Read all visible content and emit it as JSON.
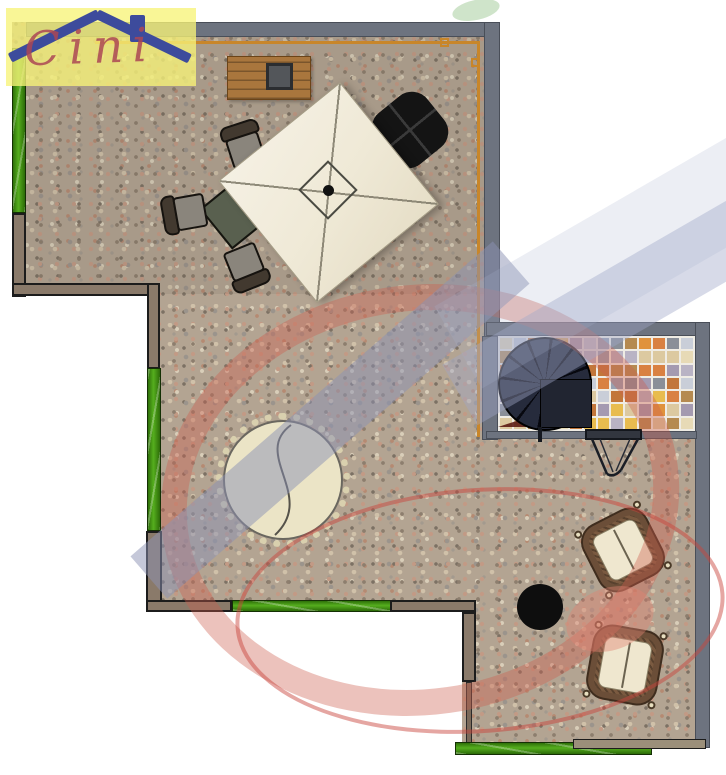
{
  "logo": {
    "text": "Cini"
  },
  "plan": {
    "kind": "terrace floor plan (top view)",
    "areas": [
      {
        "id": "upper-terrace",
        "floor": "pebble-stone"
      },
      {
        "id": "middle-terrace",
        "floor": "pebble-stone"
      },
      {
        "id": "stair-room",
        "floor": "mosaic-tiles"
      },
      {
        "id": "lower-terrace",
        "floor": "pebble-stone"
      }
    ],
    "furniture": [
      "wooden-bench",
      "serving-tray",
      "square-parasol",
      "cantilever-parasol-base",
      "dining-table",
      "dining-chair",
      "dining-chair",
      "dining-chair",
      "round-daybed",
      "spiral-staircase",
      "stair-landing",
      "folding-chair",
      "wicker-armchair",
      "wicker-armchair",
      "round-side-table"
    ]
  },
  "colors": {
    "wall_gray": "#6d737f",
    "wall_green": "#3a8a10",
    "wall_brown": "#8a7a6a",
    "wall_tan": "#9b8f7a",
    "railing_orange": "#c8862a",
    "parasol_cream": "#f0ead9",
    "watermark_red": "#cd5f50",
    "watermark_blue": "#8c92b4",
    "logo_yellow": "#f7f378",
    "logo_blue": "#3d4b9c",
    "logo_red": "#b0525a"
  },
  "mosaic": {
    "cols": 14,
    "rows": 7,
    "grout": "#efece4",
    "palette": [
      "#e0923c",
      "#e8bc4f",
      "#8a8f98",
      "#b9b3c4",
      "#dcc9a0",
      "#c2763a",
      "#99a1b1",
      "#e7dab6",
      "#b58a50",
      "#a49ab0",
      "#d98142",
      "#c9ced8"
    ]
  }
}
